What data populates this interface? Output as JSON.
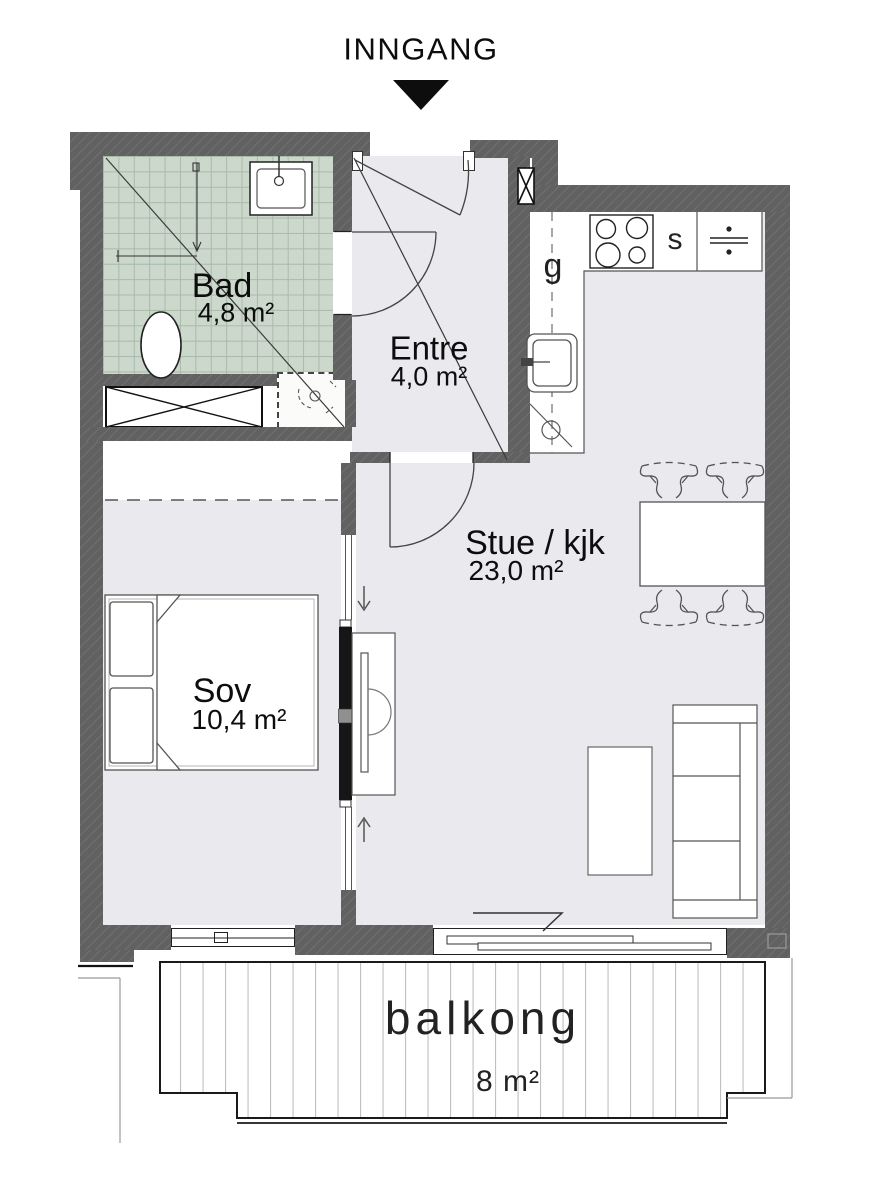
{
  "entrance": {
    "label": "INNGANG"
  },
  "rooms": {
    "bad": {
      "name": "Bad",
      "area": "4,8 m²"
    },
    "entre": {
      "name": "Entre",
      "area": "4,0 m²"
    },
    "stue": {
      "name": "Stue / kjk",
      "area": "23,0 m²"
    },
    "sov": {
      "name": "Sov",
      "area": "10,4 m²"
    },
    "balkong": {
      "name": "balkong",
      "area": "8 m²"
    }
  },
  "kitchen": {
    "cabinet_label": "g",
    "stove_label": "s"
  },
  "icons": [
    "entrance-arrow-icon",
    "stove-icon",
    "fridge-icon",
    "kitchen-sink-icon",
    "dishwasher-icon",
    "bathroom-sink-icon",
    "toilet-icon",
    "shower-drain-icon",
    "wardrobe-icon",
    "vent-shaft-icon",
    "sliding-door-icon",
    "bed-icon",
    "sofa-icon",
    "coffee-table-icon",
    "dining-table-icon",
    "chair-icon",
    "tv-bench-icon",
    "window-icon",
    "door-swing-icon"
  ],
  "colors": {
    "wall": "#616161",
    "floor": "#e9e9ee",
    "tile": "#ccd8cc",
    "tile_grid": "#a9baa9",
    "line": "#1a1a1a",
    "paper": "#ffffff",
    "furniture_stroke": "#555555"
  }
}
